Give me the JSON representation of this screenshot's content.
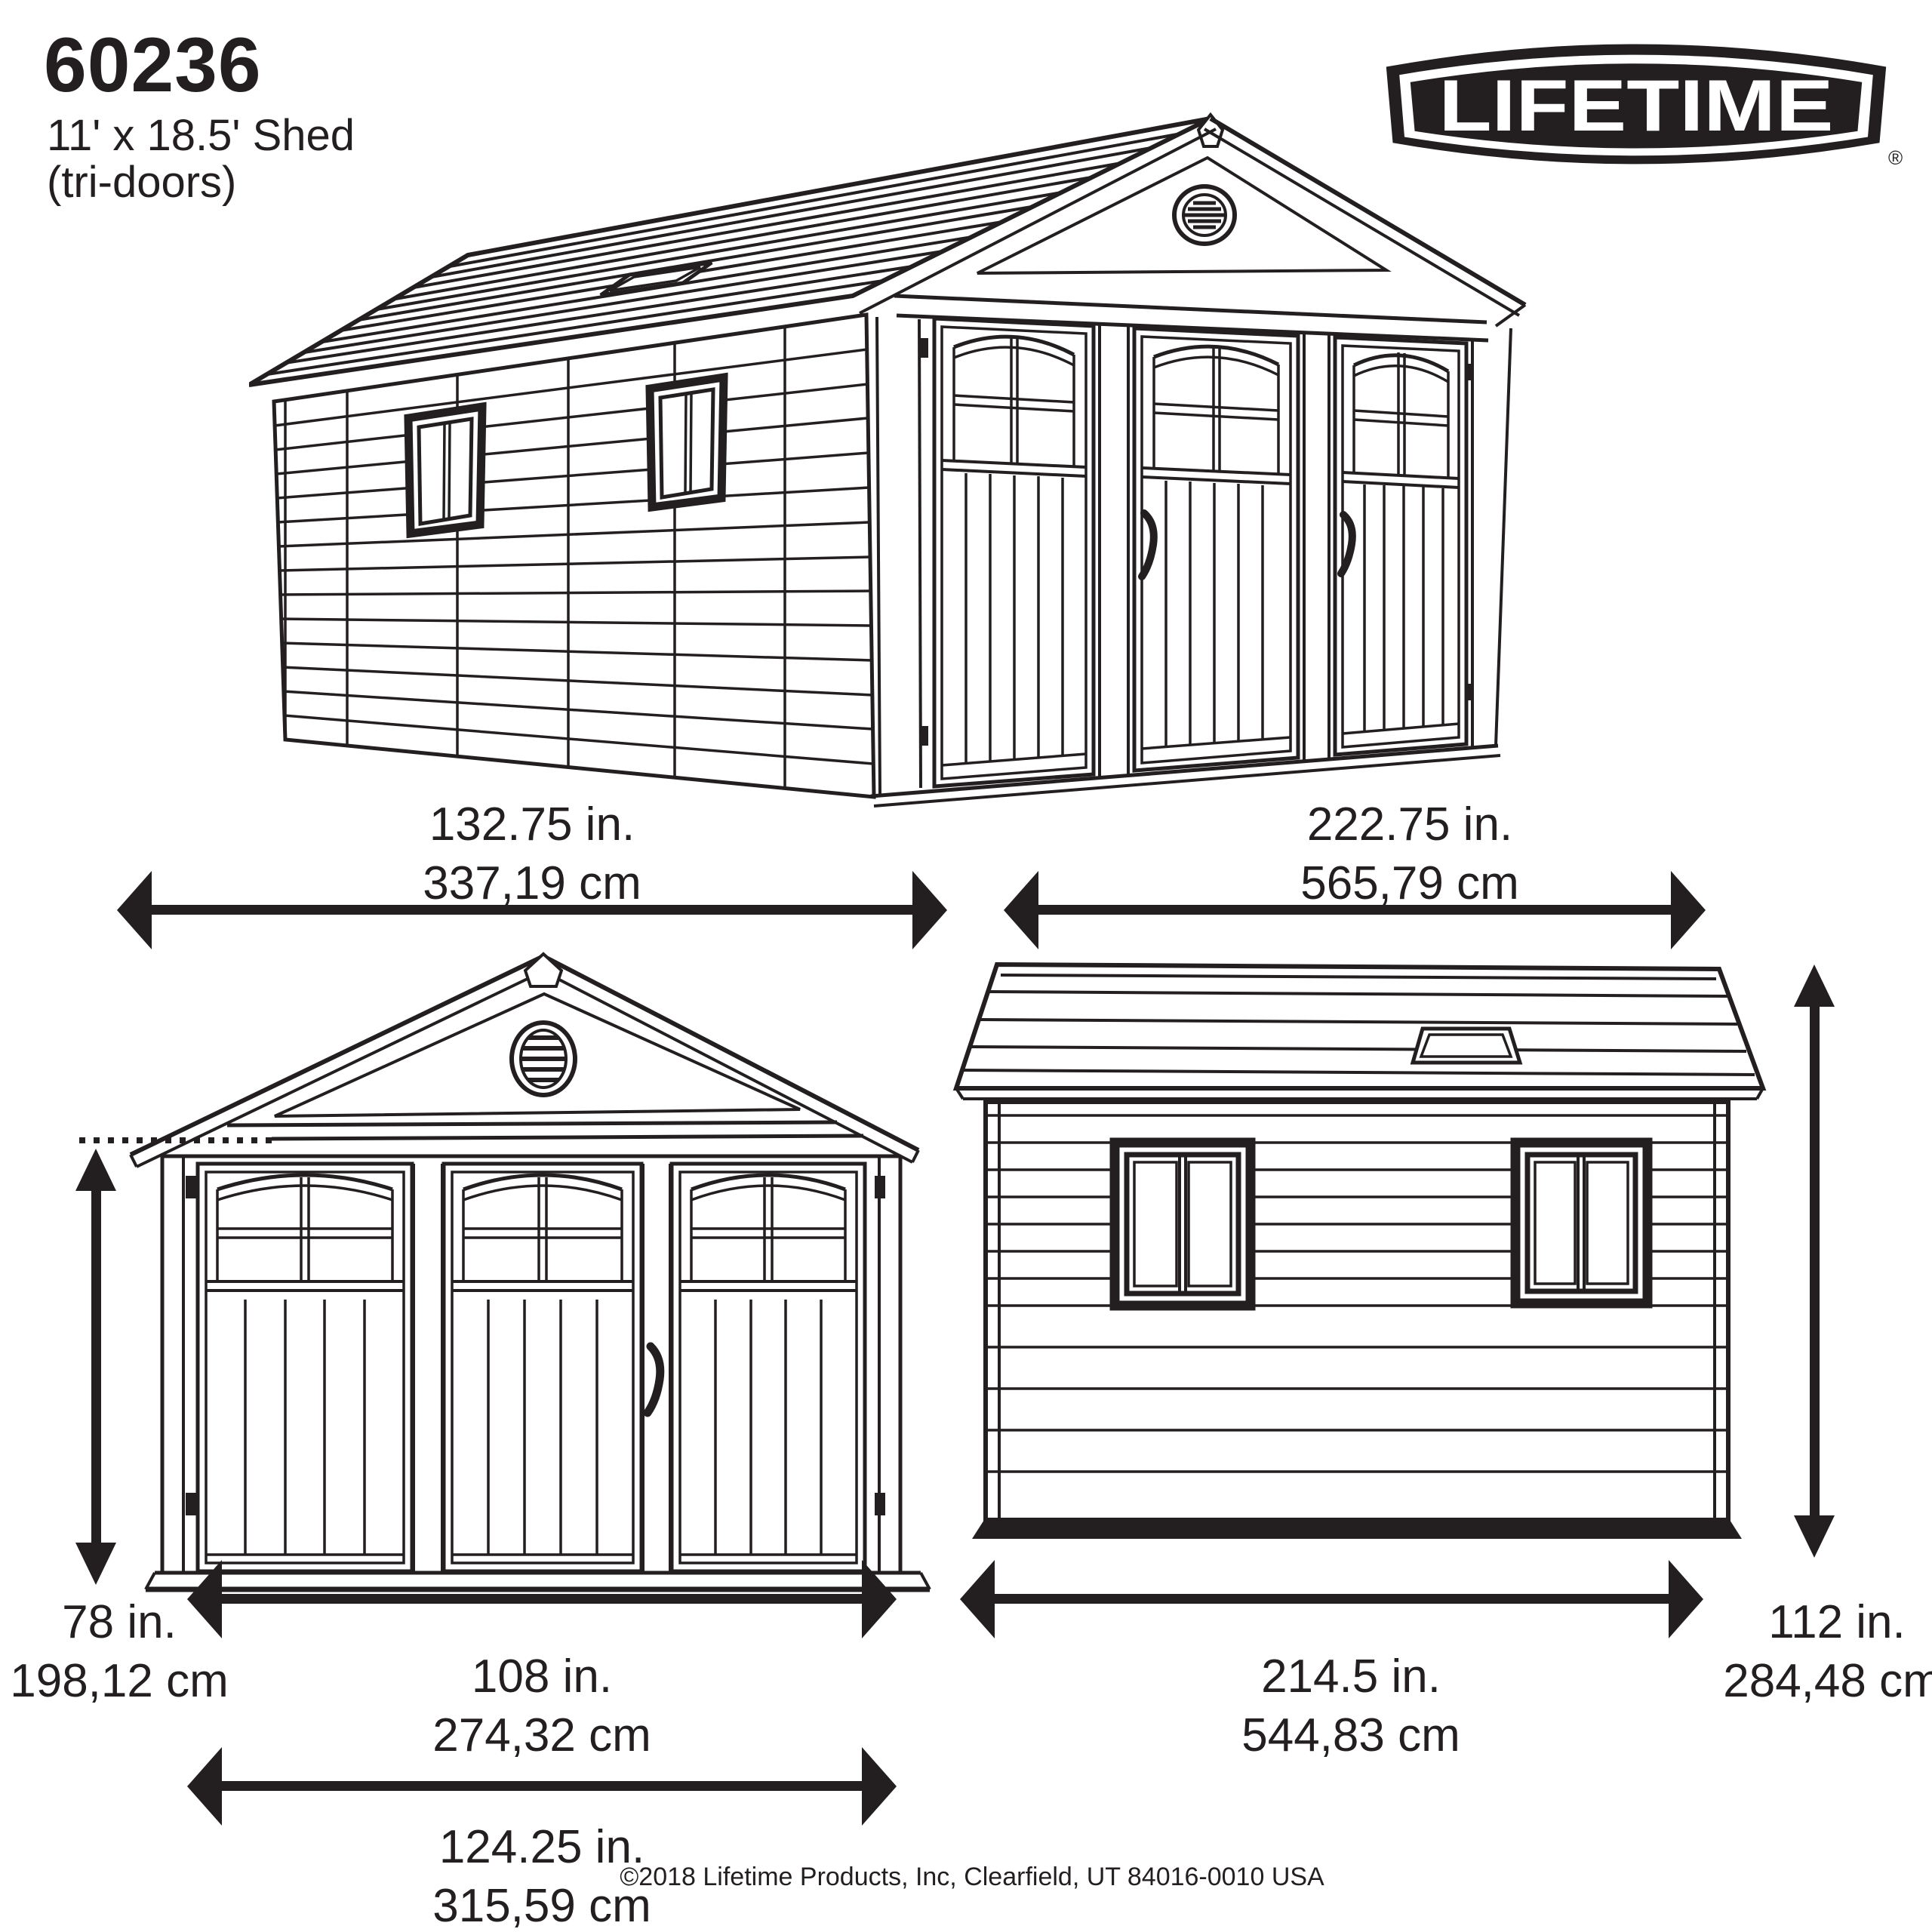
{
  "colors": {
    "ink": "#231f20",
    "paper": "#ffffff"
  },
  "header": {
    "model": "60236",
    "size": "11' x 18.5' Shed",
    "variant": "(tri-doors)"
  },
  "brand": {
    "name": "LIFETIME",
    "registered": "®"
  },
  "dimensions": {
    "front_overall_width": {
      "inches": "132.75 in.",
      "centimeters": "337,19 cm"
    },
    "side_overall_width": {
      "inches": "222.75 in.",
      "centimeters": "565,79 cm"
    },
    "door_height": {
      "inches": "78 in.",
      "centimeters": "198,12 cm"
    },
    "door_opening_width": {
      "inches": "108 in.",
      "centimeters": "274,32 cm"
    },
    "front_base_width": {
      "inches": "124.25 in.",
      "centimeters": "315,59 cm"
    },
    "side_base_width": {
      "inches": "214.5 in.",
      "centimeters": "544,83 cm"
    },
    "wall_height": {
      "inches": "112 in.",
      "centimeters": "284,48 cm"
    }
  },
  "footer": {
    "copyright": "©2018 Lifetime Products, Inc, Clearfield, UT 84016-0010 USA"
  }
}
